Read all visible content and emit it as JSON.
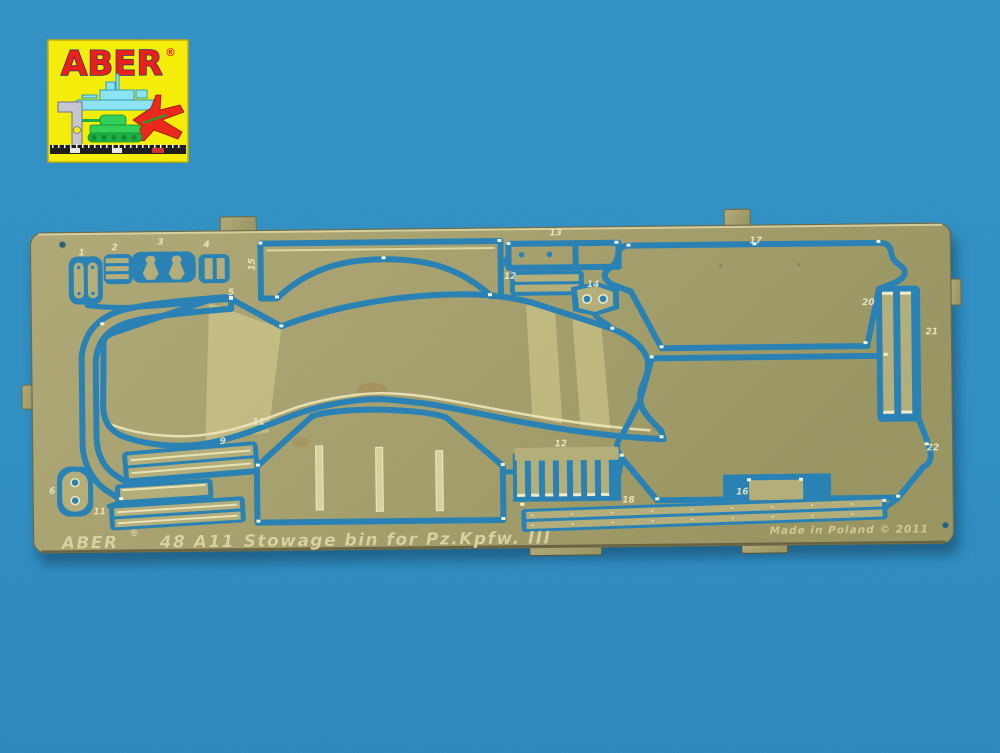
{
  "colors": {
    "background": "#2e8ec2",
    "brass": "#a8a371",
    "channel_blue": "#2a82b4",
    "etch_light": "#e9e3b4",
    "shadow": "#0b3a58",
    "logo_yellow": "#f3ed09",
    "logo_red": "#e8211a"
  },
  "logo": {
    "brand": "ABER",
    "registered": "®",
    "icons": [
      "battleship-icon",
      "jet-icon",
      "tank-icon",
      "set-square-icon",
      "ruler-icon"
    ]
  },
  "fret": {
    "etched_brand": "ABER",
    "etched_registered": "®",
    "etched_set_number": "48 A11",
    "etched_title": "Stowage bin for Pz.Kpfw. III",
    "etched_origin": "Made in Poland",
    "etched_copyright": "© 2011",
    "part_labels": [
      {
        "label": "1"
      },
      {
        "label": "2"
      },
      {
        "label": "3"
      },
      {
        "label": "4"
      },
      {
        "label": "15"
      },
      {
        "label": "5"
      },
      {
        "label": "13"
      },
      {
        "label": "12"
      },
      {
        "label": "14"
      },
      {
        "label": "17"
      },
      {
        "label": "20"
      },
      {
        "label": "21"
      },
      {
        "label": "9"
      },
      {
        "label": "11"
      },
      {
        "label": "6"
      },
      {
        "label": "11"
      },
      {
        "label": "12"
      },
      {
        "label": "18"
      },
      {
        "label": "16"
      },
      {
        "label": "22"
      }
    ]
  }
}
